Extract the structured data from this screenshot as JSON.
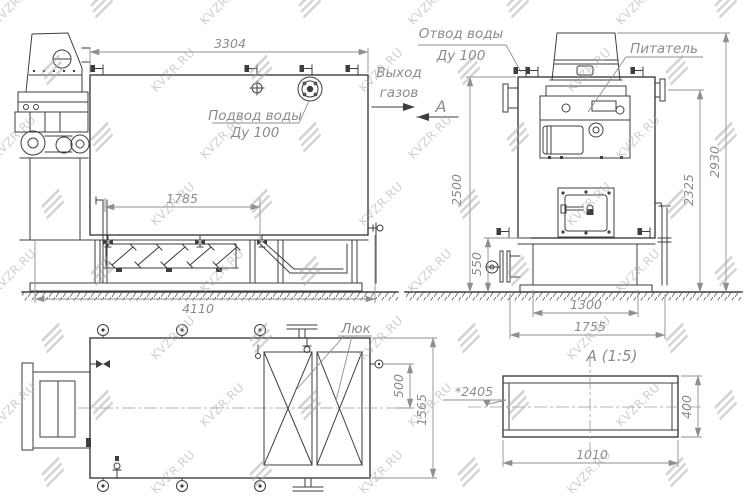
{
  "watermark": {
    "text": "KVZR.RU"
  },
  "front_view": {
    "dim_length_top": "3304",
    "dim_grate": "1785",
    "dim_length_base": "4110",
    "label_water_inlet_line1": "Подвод воды",
    "label_water_inlet_line2": "Ду 100"
  },
  "side_view": {
    "label_water_outlet_line1": "Отвод воды",
    "label_water_outlet_line2": "Ду 100",
    "label_gas_exit_line1": "Выход",
    "label_gas_exit_line2": "газов",
    "label_feeder": "Питатель",
    "section_cut_mark": "А",
    "dim_height_body": "2500",
    "dim_height_base": "550",
    "dim_base_inner": "1300",
    "dim_base_outer": "1755",
    "dim_height_flange": "2325",
    "dim_height_overall": "2930"
  },
  "top_view": {
    "label_hatch": "Люк",
    "dim_offset": "500",
    "dim_width": "1565"
  },
  "section_view": {
    "title": "А (1:5)",
    "dim_width": "1010",
    "dim_height": "400",
    "dim_axis_height": "*2405"
  }
}
